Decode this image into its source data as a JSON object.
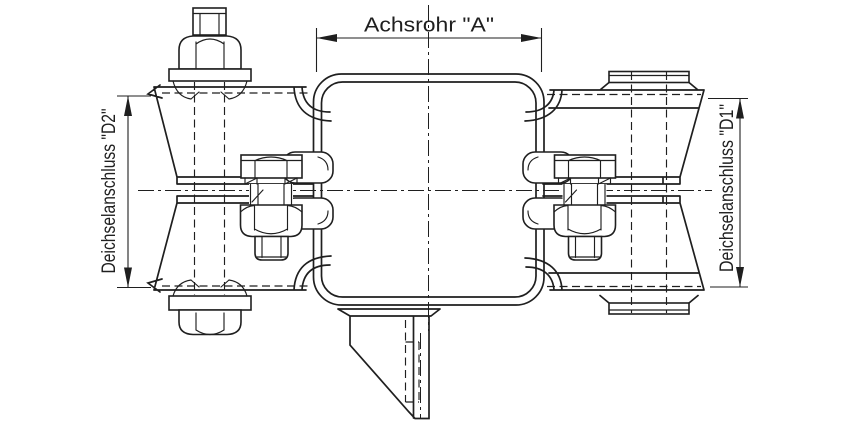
{
  "drawing": {
    "labels": {
      "axle_tube_dimension": "Achsrohr \"A\"",
      "drawbar_connection_left": "Deichselanschluss \"D2\"",
      "drawbar_connection_right": "Deichselanschluss \"D1\""
    },
    "colors": {
      "line": "#1f1f1f",
      "background": "#ffffff"
    }
  }
}
